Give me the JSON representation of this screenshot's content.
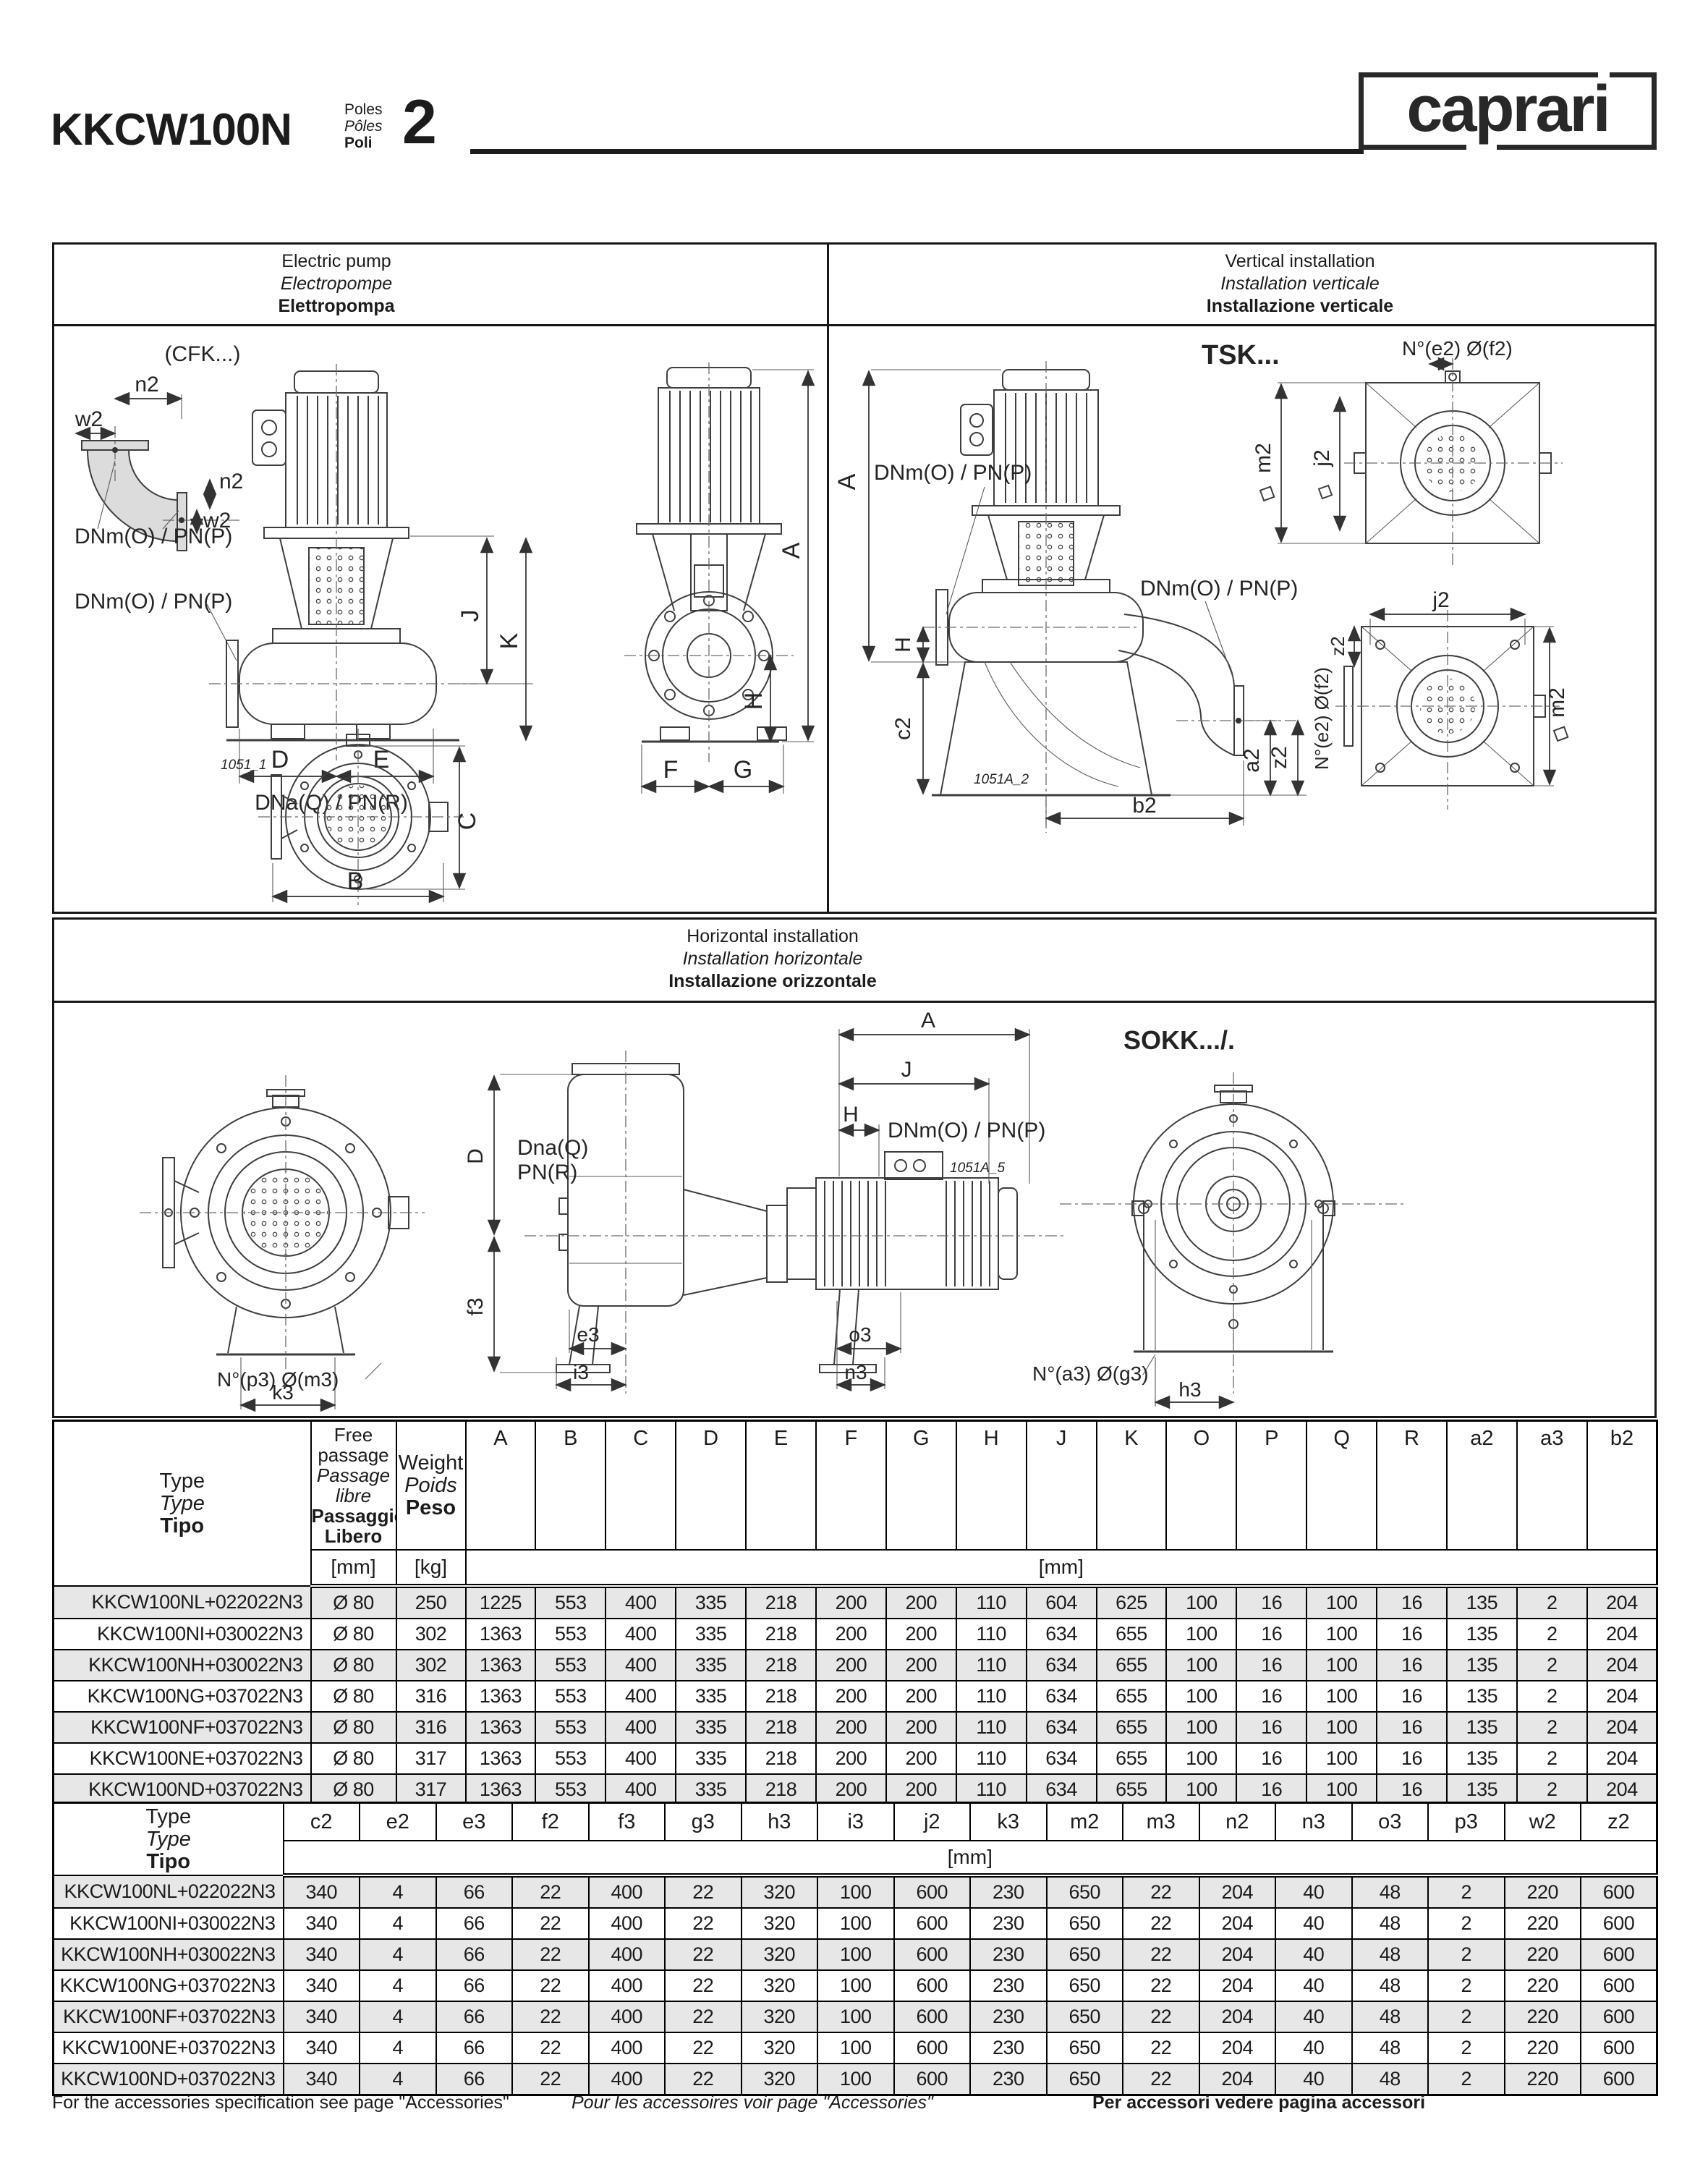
{
  "header": {
    "model": "KKCW100N",
    "poles": [
      "Poles",
      "Pôles",
      "Poli"
    ],
    "poles_value": "2",
    "logo": "caprari"
  },
  "panels": {
    "electric_pump": {
      "en": "Electric pump",
      "fr": "Electropompe",
      "it": "Elettropompa"
    },
    "vertical": {
      "en": "Vertical installation",
      "fr": "Installation verticale",
      "it": "Installazione verticale"
    },
    "horizontal": {
      "en": "Horizontal installation",
      "fr": "Installation horizontale",
      "it": "Installazione orizzontale"
    }
  },
  "drawings": {
    "cfk": "(CFK...)",
    "tsk": "TSK...",
    "sokk": "SOKK.../.",
    "dnm": "DNm(O) / PN(P)",
    "dna": "DNa(Q) / PN(R)",
    "dnaQ": "Dna(Q)",
    "pnR": "PN(R)",
    "bolt_e2": "N°(e2) Ø(f2)",
    "bolt_p3": "N°(p3) Ø(m3)",
    "bolt_a3": "N°(a3) Ø(g3)",
    "ref1": "1051_1",
    "ref2": "1051A_2",
    "ref3": "1051A_5",
    "dims": {
      "A": "A",
      "B": "B",
      "C": "C",
      "D": "D",
      "E": "E",
      "F": "F",
      "G": "G",
      "H": "H",
      "J": "J",
      "K": "K",
      "n2": "n2",
      "w2": "w2",
      "a2": "a2",
      "b2": "b2",
      "c2": "c2",
      "z2": "z2",
      "j2": "j2",
      "m2": "m2",
      "e3": "e3",
      "f3": "f3",
      "h3": "h3",
      "i3": "i3",
      "k3": "k3",
      "n3": "n3",
      "o3": "o3"
    }
  },
  "table1": {
    "type_header": [
      "Type",
      "Type",
      "Tipo"
    ],
    "free_passage_header": [
      "Free",
      "passage",
      "Passage",
      "libre",
      "Passaggio",
      "Libero"
    ],
    "weight_header": [
      "Weight",
      "Poids",
      "Peso"
    ],
    "unit_mm": "[mm]",
    "unit_kg": "[kg]",
    "col_headers": [
      "A",
      "B",
      "C",
      "D",
      "E",
      "F",
      "G",
      "H",
      "J",
      "K",
      "O",
      "P",
      "Q",
      "R",
      "a2",
      "a3",
      "b2"
    ],
    "rows": [
      {
        "type": "KKCW100NL+022022N3",
        "passage": "Ø 80",
        "weight": "250",
        "v": [
          "1225",
          "553",
          "400",
          "335",
          "218",
          "200",
          "200",
          "110",
          "604",
          "625",
          "100",
          "16",
          "100",
          "16",
          "135",
          "2",
          "204"
        ]
      },
      {
        "type": "KKCW100NI+030022N3",
        "passage": "Ø 80",
        "weight": "302",
        "v": [
          "1363",
          "553",
          "400",
          "335",
          "218",
          "200",
          "200",
          "110",
          "634",
          "655",
          "100",
          "16",
          "100",
          "16",
          "135",
          "2",
          "204"
        ]
      },
      {
        "type": "KKCW100NH+030022N3",
        "passage": "Ø 80",
        "weight": "302",
        "v": [
          "1363",
          "553",
          "400",
          "335",
          "218",
          "200",
          "200",
          "110",
          "634",
          "655",
          "100",
          "16",
          "100",
          "16",
          "135",
          "2",
          "204"
        ]
      },
      {
        "type": "KKCW100NG+037022N3",
        "passage": "Ø 80",
        "weight": "316",
        "v": [
          "1363",
          "553",
          "400",
          "335",
          "218",
          "200",
          "200",
          "110",
          "634",
          "655",
          "100",
          "16",
          "100",
          "16",
          "135",
          "2",
          "204"
        ]
      },
      {
        "type": "KKCW100NF+037022N3",
        "passage": "Ø 80",
        "weight": "316",
        "v": [
          "1363",
          "553",
          "400",
          "335",
          "218",
          "200",
          "200",
          "110",
          "634",
          "655",
          "100",
          "16",
          "100",
          "16",
          "135",
          "2",
          "204"
        ]
      },
      {
        "type": "KKCW100NE+037022N3",
        "passage": "Ø 80",
        "weight": "317",
        "v": [
          "1363",
          "553",
          "400",
          "335",
          "218",
          "200",
          "200",
          "110",
          "634",
          "655",
          "100",
          "16",
          "100",
          "16",
          "135",
          "2",
          "204"
        ]
      },
      {
        "type": "KKCW100ND+037022N3",
        "passage": "Ø 80",
        "weight": "317",
        "v": [
          "1363",
          "553",
          "400",
          "335",
          "218",
          "200",
          "200",
          "110",
          "634",
          "655",
          "100",
          "16",
          "100",
          "16",
          "135",
          "2",
          "204"
        ]
      }
    ]
  },
  "table2": {
    "type_header": [
      "Type",
      "Type",
      "Tipo"
    ],
    "unit_mm": "[mm]",
    "col_headers": [
      "c2",
      "e2",
      "e3",
      "f2",
      "f3",
      "g3",
      "h3",
      "i3",
      "j2",
      "k3",
      "m2",
      "m3",
      "n2",
      "n3",
      "o3",
      "p3",
      "w2",
      "z2"
    ],
    "rows": [
      {
        "type": "KKCW100NL+022022N3",
        "v": [
          "340",
          "4",
          "66",
          "22",
          "400",
          "22",
          "320",
          "100",
          "600",
          "230",
          "650",
          "22",
          "204",
          "40",
          "48",
          "2",
          "220",
          "600"
        ]
      },
      {
        "type": "KKCW100NI+030022N3",
        "v": [
          "340",
          "4",
          "66",
          "22",
          "400",
          "22",
          "320",
          "100",
          "600",
          "230",
          "650",
          "22",
          "204",
          "40",
          "48",
          "2",
          "220",
          "600"
        ]
      },
      {
        "type": "KKCW100NH+030022N3",
        "v": [
          "340",
          "4",
          "66",
          "22",
          "400",
          "22",
          "320",
          "100",
          "600",
          "230",
          "650",
          "22",
          "204",
          "40",
          "48",
          "2",
          "220",
          "600"
        ]
      },
      {
        "type": "KKCW100NG+037022N3",
        "v": [
          "340",
          "4",
          "66",
          "22",
          "400",
          "22",
          "320",
          "100",
          "600",
          "230",
          "650",
          "22",
          "204",
          "40",
          "48",
          "2",
          "220",
          "600"
        ]
      },
      {
        "type": "KKCW100NF+037022N3",
        "v": [
          "340",
          "4",
          "66",
          "22",
          "400",
          "22",
          "320",
          "100",
          "600",
          "230",
          "650",
          "22",
          "204",
          "40",
          "48",
          "2",
          "220",
          "600"
        ]
      },
      {
        "type": "KKCW100NE+037022N3",
        "v": [
          "340",
          "4",
          "66",
          "22",
          "400",
          "22",
          "320",
          "100",
          "600",
          "230",
          "650",
          "22",
          "204",
          "40",
          "48",
          "2",
          "220",
          "600"
        ]
      },
      {
        "type": "KKCW100ND+037022N3",
        "v": [
          "340",
          "4",
          "66",
          "22",
          "400",
          "22",
          "320",
          "100",
          "600",
          "230",
          "650",
          "22",
          "204",
          "40",
          "48",
          "2",
          "220",
          "600"
        ]
      }
    ]
  },
  "footer": {
    "en": "For the accessories specification see page \"Accessories\"",
    "fr": "Pour les accessoires voir page \"Accessories\"",
    "it": "Per accessori vedere pagina accessori"
  }
}
